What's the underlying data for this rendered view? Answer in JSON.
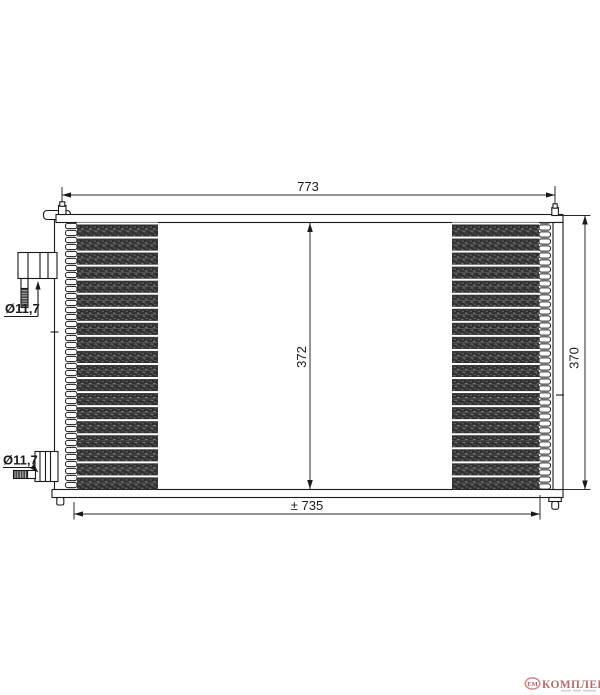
{
  "diagram": {
    "kind": "air-conditioning-condenser-technical-drawing",
    "dimensions": {
      "overall_width_label": "773",
      "core_width_label": "± 735",
      "core_height_label": "372",
      "overall_height_label": "370",
      "upper_fitting_diameter_label": "Ø11,7",
      "lower_fitting_diameter_label": "Ø11,7"
    },
    "colors": {
      "line": "#1a1a1a",
      "core_fill": "#303030",
      "dimension_line": "#2a2a2a",
      "logo_accent": "#a15757",
      "logo_oval": "#b96a6a"
    }
  },
  "watermark": {
    "badge_text": "ЕМ",
    "brand_text": "КОМПЛЕКТ"
  }
}
